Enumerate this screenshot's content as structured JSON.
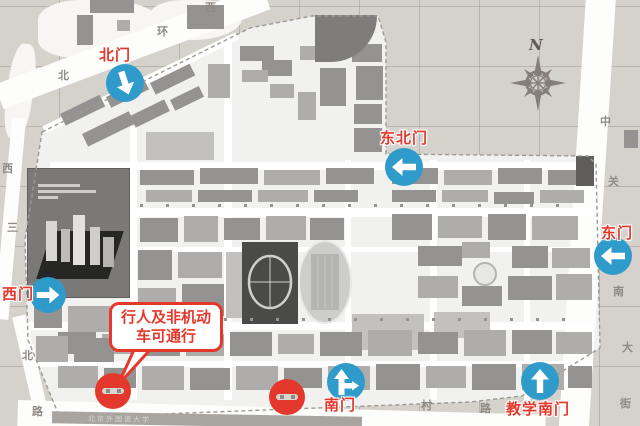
{
  "colors": {
    "background_beige": "#d5d1cb",
    "campus_fill": "#f1f1ef",
    "boundary_gray": "#9b9a96",
    "road_white": "#fdfdfc",
    "street_label_gray": "#8f8a84",
    "gate_red": "#e5382c",
    "arrow_blue": "#2f9bca",
    "compass_gray": "#857f77",
    "building_shades": [
      "#949392",
      "#767573",
      "#aeadab",
      "#c2c1bf",
      "#5e5d5b"
    ]
  },
  "compass": {
    "label": "N"
  },
  "callout": {
    "line1": "行人及非机动",
    "line2": "车可通行"
  },
  "streets": {
    "north_road_labels": [
      {
        "t": "北",
        "x": 58,
        "y": 71
      },
      {
        "t": "环",
        "x": 157,
        "y": 27
      },
      {
        "t": "西",
        "x": 205,
        "y": 3
      }
    ],
    "east_road_labels": [
      {
        "t": "中",
        "x": 600,
        "y": 117
      },
      {
        "t": "关",
        "x": 608,
        "y": 177
      },
      {
        "t": "南",
        "x": 613,
        "y": 287
      },
      {
        "t": "大",
        "x": 622,
        "y": 343
      },
      {
        "t": "街",
        "x": 620,
        "y": 399
      }
    ],
    "west_road_labels": [
      {
        "t": "西",
        "x": 2,
        "y": 164
      },
      {
        "t": "三",
        "x": 7,
        "y": 223
      },
      {
        "t": "北",
        "x": 22,
        "y": 351
      },
      {
        "t": "路",
        "x": 32,
        "y": 407
      }
    ],
    "south_road_labels": [
      {
        "t": "村",
        "x": 421,
        "y": 401
      },
      {
        "t": "路",
        "x": 480,
        "y": 404
      }
    ],
    "south_strip_label": "北京外国语大学"
  },
  "gates": [
    {
      "id": "north-gate",
      "label": "北门",
      "label_x": 99,
      "label_y": 48,
      "cx": 125,
      "cy": 83,
      "r": 19,
      "arrow": "down-right"
    },
    {
      "id": "northeast-gate",
      "label": "东北门",
      "label_x": 380,
      "label_y": 131,
      "cx": 404,
      "cy": 167,
      "r": 19,
      "arrow": "left"
    },
    {
      "id": "east-gate",
      "label": "东门",
      "label_x": 601,
      "label_y": 226,
      "cx": 613,
      "cy": 256,
      "r": 19,
      "arrow": "left"
    },
    {
      "id": "west-gate",
      "label": "西门",
      "label_x": 2,
      "label_y": 287,
      "cx": 48,
      "cy": 295,
      "r": 18,
      "arrow": "right"
    },
    {
      "id": "south-gate",
      "label": "南门",
      "label_x": 324,
      "label_y": 398,
      "cx": 346,
      "cy": 382,
      "r": 19,
      "arrow": "up-right-branch"
    },
    {
      "id": "teaching-south-gate",
      "label": "教学南门",
      "label_x": 506,
      "label_y": 402,
      "cx": 540,
      "cy": 381,
      "r": 19,
      "arrow": "up"
    }
  ],
  "closed_gates": [
    {
      "cx": 113,
      "cy": 391,
      "r": 18
    },
    {
      "cx": 287,
      "cy": 397,
      "r": 18
    }
  ],
  "map": {
    "patches": [
      [
        38,
        0,
        125,
        58,
        "45% 60% 70% 40%",
        0
      ],
      [
        150,
        0,
        92,
        40,
        "40% 50% 60% 50%",
        0
      ],
      [
        14,
        42,
        26,
        96,
        "40%",
        8
      ]
    ],
    "roads_internal": [
      [
        130,
        126,
        7,
        274,
        0
      ],
      [
        224,
        42,
        8,
        358,
        0
      ],
      [
        345,
        160,
        6,
        240,
        0
      ],
      [
        430,
        160,
        7,
        240,
        0
      ],
      [
        524,
        160,
        6,
        240,
        0
      ],
      [
        50,
        162,
        540,
        8,
        0
      ],
      [
        38,
        208,
        556,
        9,
        0
      ],
      [
        133,
        247,
        460,
        5,
        0
      ],
      [
        28,
        322,
        566,
        8,
        0
      ],
      [
        33,
        361,
        560,
        6,
        0
      ],
      [
        44,
        126,
        215,
        8,
        -26
      ]
    ],
    "buildings": [
      [
        60,
        114,
        44,
        13,
        0,
        -26
      ],
      [
        106,
        97,
        42,
        12,
        0,
        -26
      ],
      [
        150,
        83,
        44,
        13,
        0,
        -26
      ],
      [
        82,
        134,
        52,
        14,
        0,
        -26
      ],
      [
        130,
        116,
        38,
        13,
        0,
        -26
      ],
      [
        170,
        100,
        32,
        12,
        0,
        -26
      ],
      [
        90,
        0,
        44,
        13,
        0,
        0
      ],
      [
        77,
        15,
        16,
        30,
        0,
        0
      ],
      [
        117,
        20,
        13,
        11,
        2,
        0
      ],
      [
        187,
        5,
        37,
        24,
        0,
        0
      ],
      [
        352,
        44,
        30,
        18,
        0,
        0
      ],
      [
        356,
        66,
        27,
        34,
        0,
        0
      ],
      [
        354,
        104,
        28,
        20,
        0,
        0
      ],
      [
        354,
        128,
        28,
        24,
        0,
        0
      ],
      [
        320,
        68,
        26,
        38,
        0,
        0
      ],
      [
        298,
        92,
        18,
        28,
        2,
        0
      ],
      [
        262,
        60,
        30,
        16,
        0,
        0
      ],
      [
        270,
        84,
        24,
        14,
        2,
        0
      ],
      [
        240,
        46,
        34,
        15,
        0,
        0
      ],
      [
        242,
        70,
        26,
        12,
        2,
        0
      ],
      [
        300,
        46,
        26,
        14,
        2,
        0
      ],
      [
        208,
        64,
        22,
        34,
        2,
        0
      ],
      [
        146,
        132,
        68,
        28,
        3,
        0
      ],
      [
        140,
        170,
        54,
        15,
        0,
        0
      ],
      [
        200,
        168,
        58,
        16,
        0,
        0
      ],
      [
        264,
        170,
        56,
        15,
        2,
        0
      ],
      [
        326,
        168,
        48,
        16,
        0,
        0
      ],
      [
        392,
        168,
        46,
        16,
        0,
        0
      ],
      [
        444,
        170,
        48,
        15,
        2,
        0
      ],
      [
        498,
        168,
        44,
        16,
        0,
        0
      ],
      [
        548,
        170,
        38,
        15,
        0,
        0
      ],
      [
        146,
        190,
        46,
        12,
        2,
        0
      ],
      [
        198,
        190,
        54,
        12,
        0,
        0
      ],
      [
        258,
        190,
        50,
        12,
        2,
        0
      ],
      [
        314,
        190,
        44,
        12,
        0,
        0
      ],
      [
        392,
        190,
        44,
        12,
        0,
        0
      ],
      [
        442,
        190,
        46,
        12,
        2,
        0
      ],
      [
        494,
        192,
        40,
        12,
        0,
        0
      ],
      [
        540,
        190,
        44,
        13,
        2,
        0
      ],
      [
        576,
        156,
        18,
        30,
        4,
        0
      ],
      [
        140,
        218,
        38,
        24,
        0,
        0
      ],
      [
        184,
        216,
        34,
        26,
        2,
        0
      ],
      [
        224,
        218,
        36,
        22,
        0,
        0
      ],
      [
        266,
        216,
        40,
        24,
        2,
        0
      ],
      [
        310,
        218,
        34,
        22,
        0,
        0
      ],
      [
        392,
        214,
        40,
        26,
        0,
        0
      ],
      [
        438,
        216,
        44,
        22,
        2,
        0
      ],
      [
        488,
        214,
        38,
        26,
        0,
        0
      ],
      [
        532,
        216,
        46,
        24,
        2,
        0
      ],
      [
        138,
        250,
        34,
        30,
        0,
        0
      ],
      [
        178,
        252,
        44,
        26,
        2,
        0
      ],
      [
        138,
        288,
        38,
        30,
        2,
        0
      ],
      [
        182,
        284,
        42,
        32,
        0,
        0
      ],
      [
        226,
        252,
        16,
        66,
        3,
        0
      ],
      [
        418,
        246,
        44,
        20,
        0,
        0
      ],
      [
        512,
        246,
        36,
        22,
        0,
        0
      ],
      [
        552,
        248,
        38,
        20,
        2,
        0
      ],
      [
        418,
        276,
        40,
        22,
        2,
        0
      ],
      [
        462,
        286,
        40,
        20,
        0,
        0
      ],
      [
        508,
        276,
        44,
        24,
        0,
        0
      ],
      [
        556,
        274,
        36,
        26,
        2,
        0
      ],
      [
        462,
        242,
        28,
        16,
        2,
        0
      ],
      [
        352,
        314,
        72,
        36,
        3,
        0
      ],
      [
        434,
        312,
        56,
        26,
        3,
        0
      ],
      [
        58,
        332,
        38,
        22,
        0,
        0
      ],
      [
        102,
        334,
        30,
        20,
        2,
        0
      ],
      [
        138,
        332,
        42,
        24,
        0,
        0
      ],
      [
        186,
        334,
        38,
        22,
        2,
        0
      ],
      [
        230,
        332,
        42,
        24,
        0,
        0
      ],
      [
        278,
        334,
        36,
        20,
        2,
        0
      ],
      [
        320,
        332,
        42,
        24,
        0,
        0
      ],
      [
        368,
        330,
        44,
        26,
        2,
        0
      ],
      [
        418,
        332,
        40,
        22,
        0,
        0
      ],
      [
        464,
        330,
        42,
        26,
        2,
        0
      ],
      [
        512,
        330,
        40,
        24,
        0,
        0
      ],
      [
        556,
        332,
        36,
        22,
        2,
        0
      ],
      [
        58,
        366,
        40,
        22,
        2,
        0
      ],
      [
        104,
        368,
        32,
        20,
        0,
        0
      ],
      [
        142,
        366,
        42,
        24,
        2,
        0
      ],
      [
        190,
        368,
        40,
        22,
        0,
        0
      ],
      [
        236,
        366,
        42,
        24,
        2,
        0
      ],
      [
        284,
        368,
        38,
        20,
        0,
        0
      ],
      [
        328,
        366,
        42,
        24,
        2,
        0
      ],
      [
        376,
        364,
        44,
        26,
        0,
        0
      ],
      [
        426,
        366,
        40,
        22,
        2,
        0
      ],
      [
        472,
        364,
        44,
        26,
        0,
        0
      ],
      [
        522,
        364,
        42,
        26,
        2,
        0
      ],
      [
        568,
        366,
        24,
        22,
        0,
        0
      ],
      [
        34,
        304,
        28,
        24,
        0,
        0
      ],
      [
        68,
        306,
        42,
        26,
        2,
        0
      ],
      [
        36,
        336,
        32,
        26,
        2,
        0
      ],
      [
        74,
        338,
        40,
        24,
        0,
        0
      ],
      [
        624,
        130,
        14,
        18,
        0,
        0
      ]
    ]
  }
}
